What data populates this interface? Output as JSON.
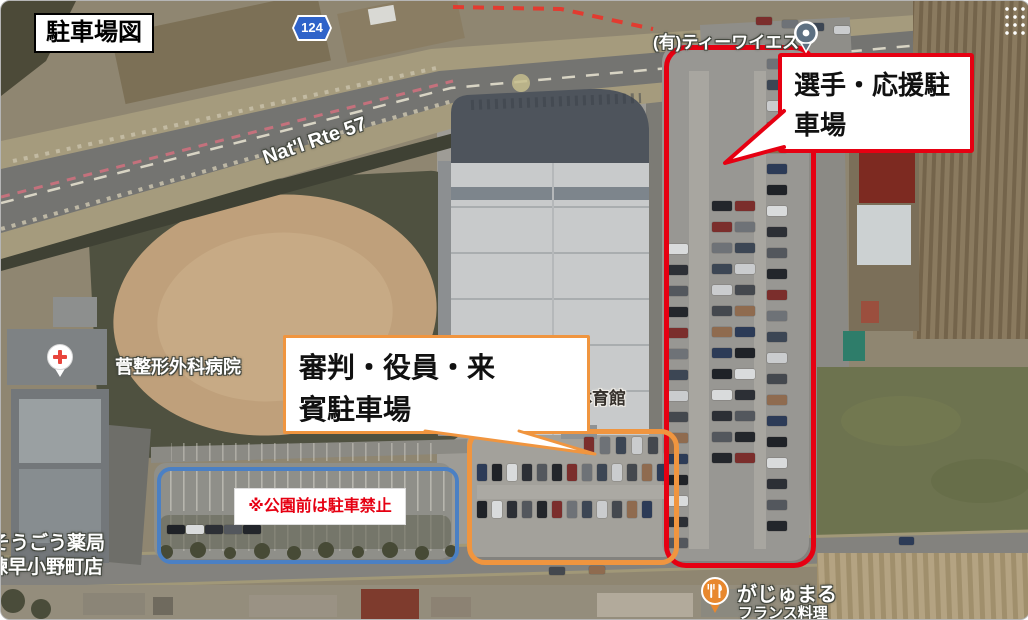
{
  "annotations": {
    "title": "駐車場図",
    "players_line1": "選手・応援駐",
    "players_line2": "車場",
    "officials_line1": "審判・役員・来",
    "officials_line2": "賓駐車場",
    "no_parking": "※公園前は駐車禁止"
  },
  "zone_colors": {
    "players_parking": "#e60012",
    "officials_parking": "#f0953f",
    "no_parking_area": "#4b80c4",
    "note_text": "#e60012"
  },
  "map_labels": {
    "route_shield": "124",
    "national_route": "Nat'l Rte 57",
    "business": "(有)ティーワイエス",
    "hospital": "菅整形外科病院",
    "gymnasium": "小野体育館",
    "pharmacy_line1": "そうごう薬局",
    "pharmacy_line2": "諫早小野町店",
    "restaurant_name": "がじゅまる",
    "restaurant_genre": "フランス料理"
  },
  "icons": {
    "business_pin": "gray-poi-pin",
    "hospital_pin": "white-pin-red-cross",
    "gymnasium_pin": "red-map-pin",
    "restaurant_pin": "orange-restaurant-pin"
  }
}
